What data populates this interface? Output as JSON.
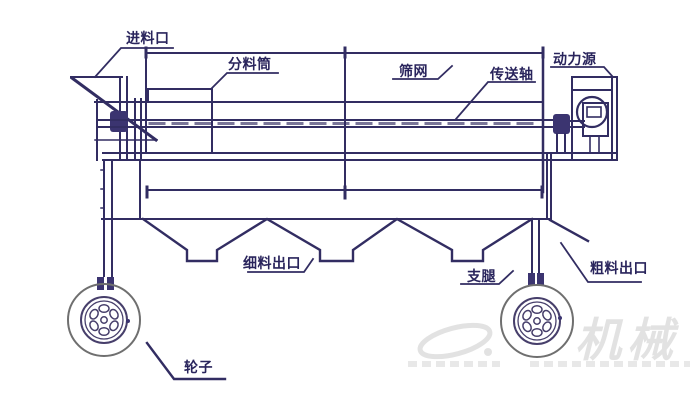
{
  "labels": {
    "feed_inlet": "进料口",
    "distribution_cylinder": "分料筒",
    "screen_mesh": "筛网",
    "transmission_shaft": "传送轴",
    "power_source": "动力源",
    "fine_outlet": "细料出口",
    "support_leg": "支腿",
    "coarse_outlet": "粗料出口",
    "wheel": "轮子"
  },
  "watermark": {
    "brand": "机械"
  },
  "colors": {
    "line": "#322d62",
    "label_text": "#29245c",
    "tire_outline": "#6f6f6f",
    "watermark": "#dcdcdc",
    "background": "#ffffff"
  }
}
